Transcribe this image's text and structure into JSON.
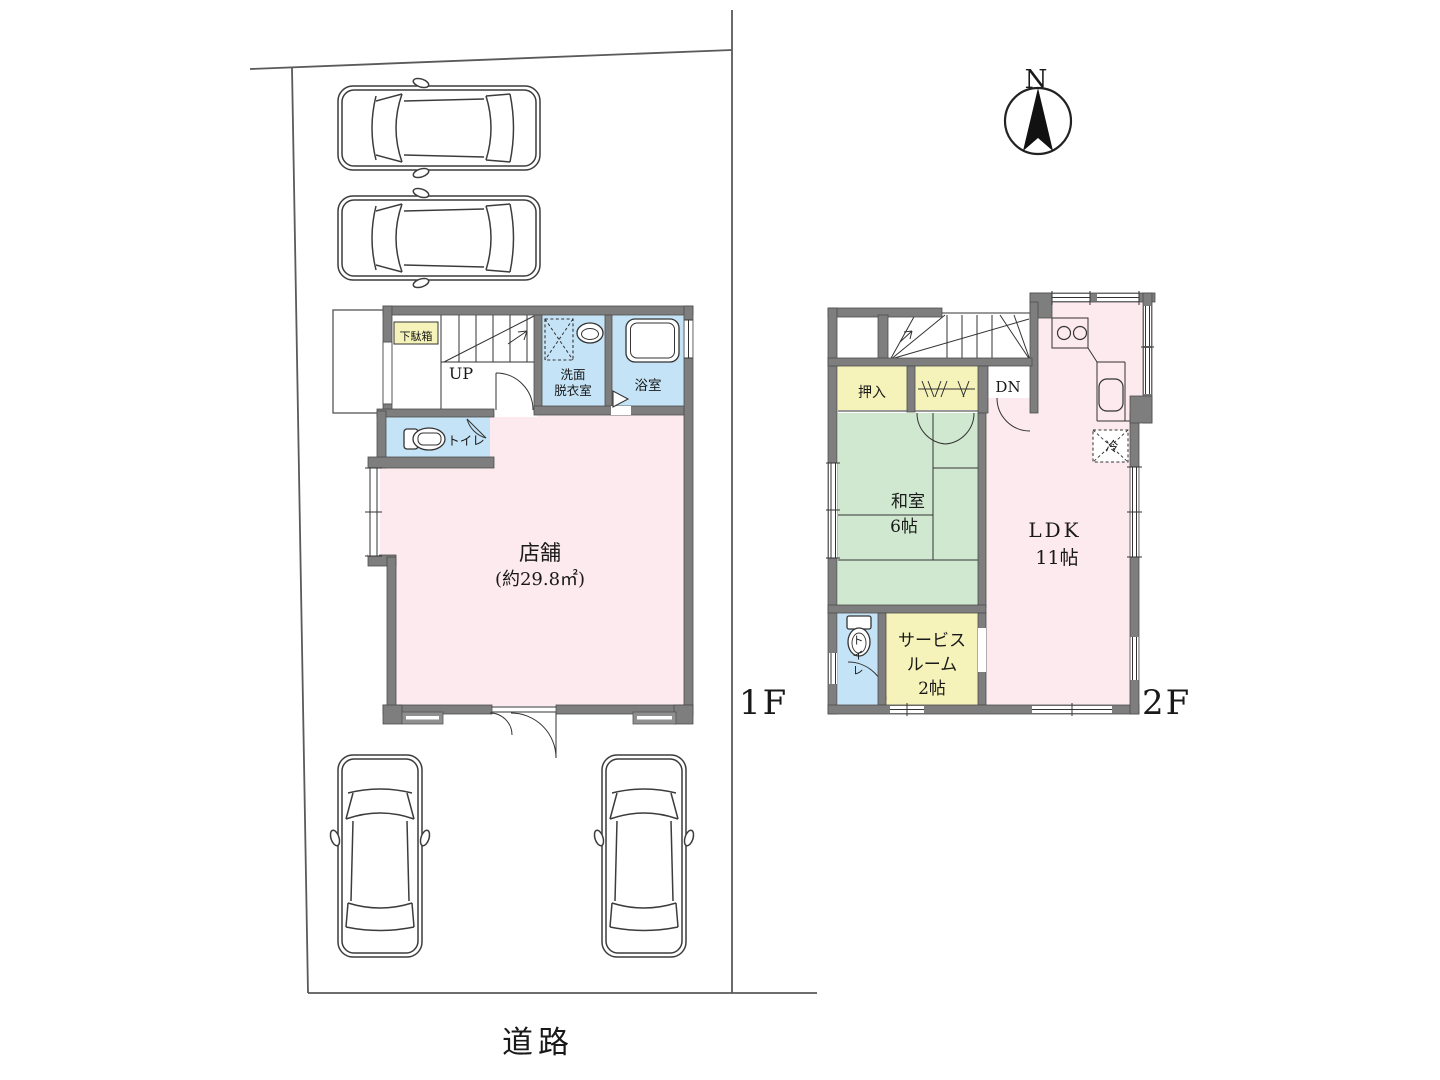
{
  "site": {
    "road_label": "道路"
  },
  "compass": {
    "north_label": "N"
  },
  "floor1": {
    "label": "1F",
    "rooms": {
      "shoe_cabinet": "下駄箱",
      "stairs_up": "UP",
      "washroom_line1": "洗面",
      "washroom_line2": "脱衣室",
      "bathroom": "浴室",
      "toilet": "トイレ",
      "shop_name": "店舗",
      "shop_area": "(約29.8㎡)"
    }
  },
  "floor2": {
    "label": "2F",
    "rooms": {
      "closet": "押入",
      "stairs_down": "DN",
      "japanese_room_name": "和室",
      "japanese_room_size": "6帖",
      "ldk_name": "LDK",
      "ldk_size": "11帖",
      "service_room_line1": "サービス",
      "service_room_line2": "ルーム",
      "service_room_line3": "2帖",
      "refrigerator": "冷",
      "toilet_chars": [
        "ト",
        "イ",
        "レ"
      ]
    }
  },
  "colors": {
    "wall": "#7e7e7e",
    "room_pink": "#fceaee",
    "room_blue": "#c5e3f6",
    "room_green": "#cfe8cf",
    "room_yellow": "#f5f3ba",
    "line": "#333333",
    "text": "#191919"
  }
}
